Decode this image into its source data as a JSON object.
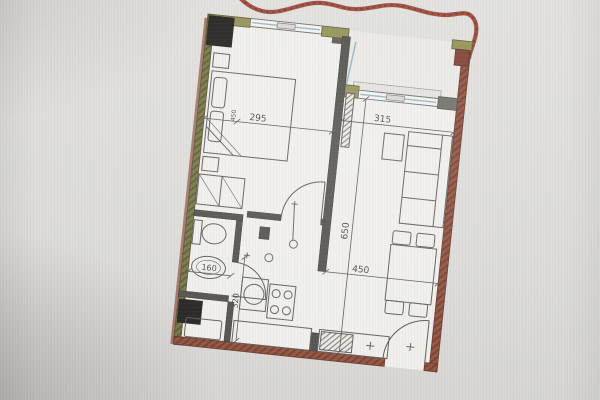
{
  "plan": {
    "dimensions": {
      "bedroom_width": "295",
      "bedroom_side": "450",
      "living_top_width": "315",
      "living_depth": "650",
      "living_width": "450",
      "bathroom_width": "160",
      "kitchen_depth": "320"
    },
    "colors": {
      "photo_background": "#d9d8d5",
      "paper": "#efeeeb",
      "brick_wall": "#8e4b37",
      "insulated_wall": "#72713f",
      "interior_wall": "#4b4a46",
      "corner_block": "#8f8e4e",
      "window_glass": "#8fb3bd",
      "marker_red": "#8e2f1e",
      "shaft_black": "#1d1b1a",
      "line": "#55534f"
    },
    "symbols": [
      "bed",
      "wardrobe",
      "nightstand",
      "toilet",
      "bath-sink",
      "washing-machine",
      "duct-shaft",
      "kitchen-sink",
      "stove",
      "counter",
      "sofa",
      "side-table",
      "dining-table",
      "chair",
      "radiator",
      "door-swing",
      "window",
      "terrace",
      "red-marker-line"
    ]
  }
}
